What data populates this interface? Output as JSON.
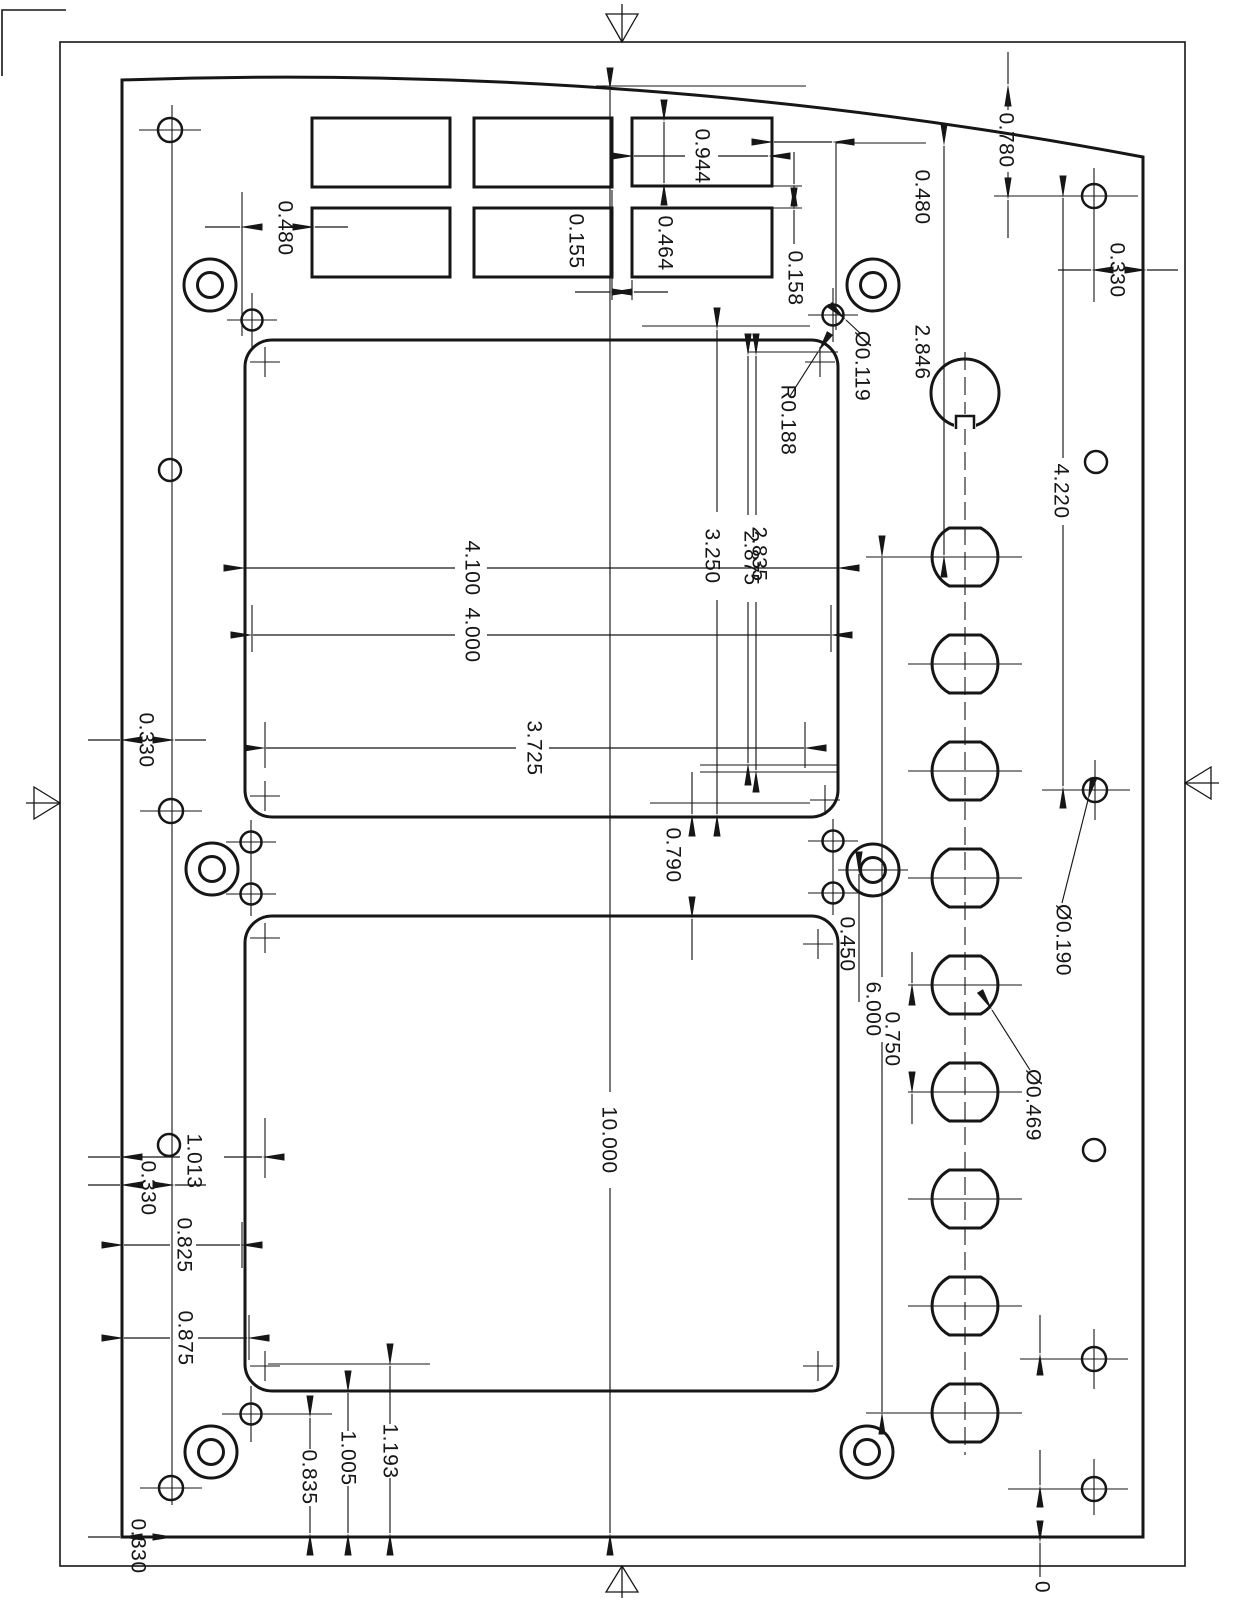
{
  "page": {
    "background": "#ffffff",
    "line_color": "#161616"
  },
  "labels": {
    "dim_0944": "0.944",
    "dim_0480_left": "0.480",
    "dim_0155": "0.155",
    "dim_0464": "0.464",
    "dim_0158": "0.158",
    "dim_0780": "0.780",
    "dim_0480_right": "0.480",
    "dim_0330_topright": "0.330",
    "dia_0119": "Ø0.119",
    "rad_0188": "R0.188",
    "dim_2846": "2.846",
    "dim_4220": "4.220",
    "dim_3250": "3.250",
    "dim_2875": "2.875",
    "dim_2835": "2.835",
    "dim_4100": "4.100",
    "dim_4000": "4.000",
    "dim_3725": "3.725",
    "dim_0330_left": "0.330",
    "dim_0790": "0.790",
    "dim_0450": "0.450",
    "dim_6000": "6.000",
    "dim_0750": "0.750",
    "dia_0190": "Ø0.190",
    "dia_0469": "Ø0.469",
    "dim_10000": "10.000",
    "dim_1013": "1.013",
    "dim_0330_bottomleft": "0.330",
    "dim_0825": "0.825",
    "dim_0875": "0.875",
    "dim_1193": "1.193",
    "dim_1005": "1.005",
    "dim_0835": "0.835",
    "dim_0330_bottom": "0.330",
    "origin_zero": "0"
  }
}
